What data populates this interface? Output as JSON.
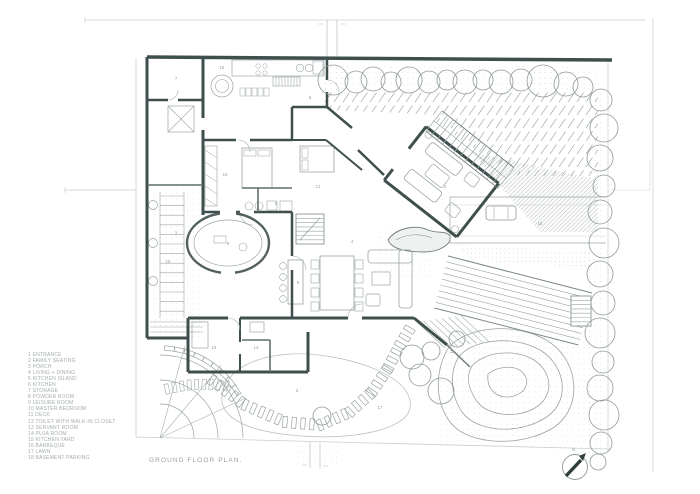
{
  "sheet": {
    "title": "GROUND FLOOR PLAN.",
    "north_label": "N",
    "legend": {
      "items": [
        "1 ENTRANCE",
        "2 FAMILY SEATING",
        "3 PORCH",
        "4 LIVING + DINING",
        "5 KITCHEN ISLAND",
        "6 KITCHEN",
        "7 STORAGE",
        "8 POWDER ROOM",
        "9 LEISURE ROOM",
        "10 MASTER BEDROOM",
        "11 DECK",
        "12 TOILET WITH WALK-IN CLOSET",
        "13 SERVANT ROOM",
        "14 PUJA ROOM",
        "15 KITCHEN YARD",
        "16 BARBEQUE",
        "17 LAWN",
        "18 BASEMENT PARKING"
      ]
    },
    "room_labels": [
      {
        "n": "1",
        "x": 176,
        "y": 234
      },
      {
        "n": "2",
        "x": 445,
        "y": 188
      },
      {
        "n": "3",
        "x": 297,
        "y": 392
      },
      {
        "n": "4",
        "x": 352,
        "y": 243
      },
      {
        "n": "5",
        "x": 298,
        "y": 284
      },
      {
        "n": "6",
        "x": 310,
        "y": 99
      },
      {
        "n": "7",
        "x": 176,
        "y": 80
      },
      {
        "n": "8",
        "x": 276,
        "y": 205
      },
      {
        "n": "9",
        "x": 228,
        "y": 245
      },
      {
        "n": "10",
        "x": 225,
        "y": 176
      },
      {
        "n": "11",
        "x": 452,
        "y": 353
      },
      {
        "n": "12",
        "x": 318,
        "y": 188
      },
      {
        "n": "13",
        "x": 214,
        "y": 349
      },
      {
        "n": "14",
        "x": 256,
        "y": 349
      },
      {
        "n": "15",
        "x": 168,
        "y": 263
      },
      {
        "n": "16",
        "x": 222,
        "y": 69
      },
      {
        "n": "17",
        "x": 380,
        "y": 409
      },
      {
        "n": "18",
        "x": 540,
        "y": 225
      }
    ],
    "colors": {
      "wall": "#3f4f4d",
      "wall2": "#5f6e6c",
      "line": "#9aa5a3",
      "faint": "#c9cfce",
      "text": "#97a29f",
      "paper": "#ffffff"
    }
  }
}
